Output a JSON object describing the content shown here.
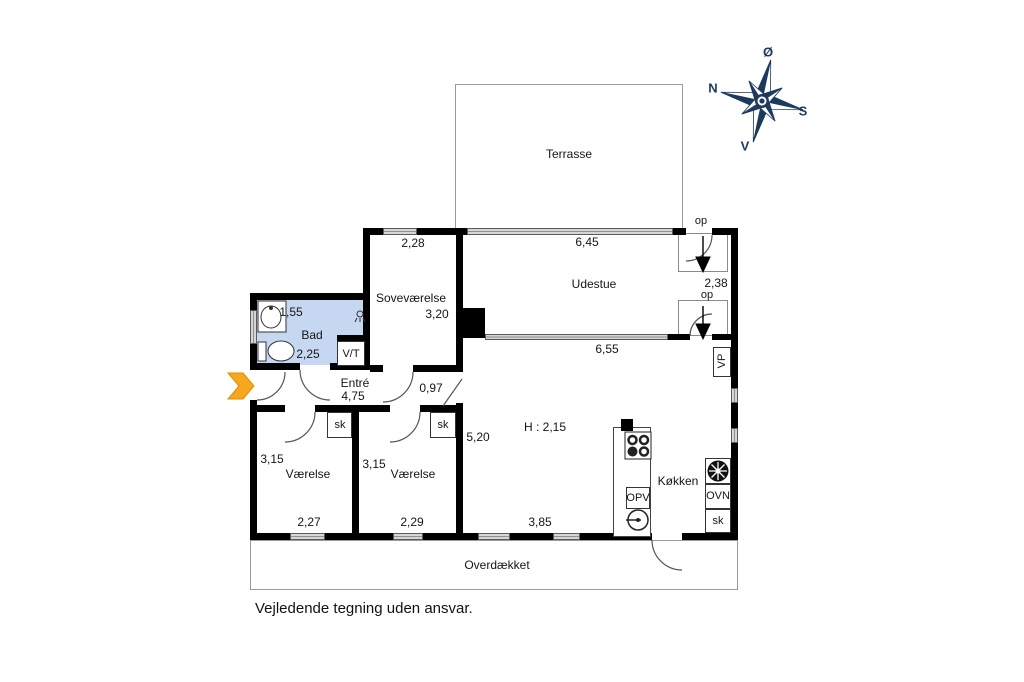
{
  "drawing": {
    "type": "floor-plan",
    "footer_disclaimer": "Vejledende tegning uden ansvar."
  },
  "colors": {
    "bathroom_blue": "#c6d7f2",
    "arrow_orange": "#F6A71B",
    "compass_navy": "#1d3a5c",
    "wall_black": "#000000",
    "window_gray": "#8f8f8f"
  },
  "compass": {
    "letters": [
      {
        "name": "compass-letter-east",
        "text": "Ø",
        "x": 768,
        "y": 52
      },
      {
        "name": "compass-letter-north",
        "text": "N",
        "x": 713,
        "y": 88
      },
      {
        "name": "compass-letter-south",
        "text": "S",
        "x": 803,
        "y": 111
      },
      {
        "name": "compass-letter-west",
        "text": "V",
        "x": 745,
        "y": 146
      }
    ]
  },
  "labels": [
    {
      "name": "room-label-terrasse",
      "text": "Terrasse",
      "x": 569,
      "y": 154
    },
    {
      "name": "dim-sovevaerelse-width",
      "text": "2,28",
      "x": 413,
      "y": 243
    },
    {
      "name": "dim-udestue-window",
      "text": "6,45",
      "x": 587,
      "y": 242
    },
    {
      "name": "room-label-sovevaerelse",
      "text": "Soveværelse",
      "x": 411,
      "y": 298
    },
    {
      "name": "dim-sovevaerelse-depth",
      "text": "3,20",
      "x": 437,
      "y": 314
    },
    {
      "name": "room-label-udestue",
      "text": "Udestue",
      "x": 594,
      "y": 284
    },
    {
      "name": "step-label-op-1",
      "text": "op",
      "x": 701,
      "y": 221,
      "cls": "small"
    },
    {
      "name": "dim-udestue-depth",
      "text": "2,38",
      "x": 716,
      "y": 283
    },
    {
      "name": "step-label-op-2",
      "text": "op",
      "x": 707,
      "y": 295,
      "cls": "small"
    },
    {
      "name": "dim-living-window",
      "text": "6,55",
      "x": 607,
      "y": 349
    },
    {
      "name": "dim-bad-width",
      "text": "1,55",
      "x": 291,
      "y": 312
    },
    {
      "name": "room-label-bad",
      "text": "Bad",
      "x": 312,
      "y": 335
    },
    {
      "name": "dim-bad-depth",
      "text": "2,25",
      "x": 308,
      "y": 354
    },
    {
      "name": "closet-label-vt",
      "text": "V/T",
      "x": 351,
      "y": 354,
      "cls": "small"
    },
    {
      "name": "room-label-entre",
      "text": "Entré",
      "x": 355,
      "y": 383
    },
    {
      "name": "dim-entre-width",
      "text": "4,75",
      "x": 353,
      "y": 396
    },
    {
      "name": "dim-door-width",
      "text": "0,97",
      "x": 431,
      "y": 388
    },
    {
      "name": "closet-label-sk-1",
      "text": "sk",
      "x": 340,
      "y": 425,
      "cls": "small"
    },
    {
      "name": "closet-label-sk-2",
      "text": "sk",
      "x": 443,
      "y": 425,
      "cls": "small"
    },
    {
      "name": "dim-vaerelse1-depth",
      "text": "3,15",
      "x": 272,
      "y": 459
    },
    {
      "name": "room-label-vaerelse-1",
      "text": "Værelse",
      "x": 308,
      "y": 474
    },
    {
      "name": "dim-vaerelse2-depth",
      "text": "3,15",
      "x": 374,
      "y": 464
    },
    {
      "name": "room-label-vaerelse-2",
      "text": "Værelse",
      "x": 413,
      "y": 474
    },
    {
      "name": "dim-vaerelse1-width",
      "text": "2,27",
      "x": 309,
      "y": 522
    },
    {
      "name": "dim-vaerelse2-width",
      "text": "2,29",
      "x": 412,
      "y": 522
    },
    {
      "name": "dim-living-depth",
      "text": "5,20",
      "x": 478,
      "y": 437
    },
    {
      "name": "label-ceiling-height",
      "text": "H : 2,15",
      "x": 545,
      "y": 427
    },
    {
      "name": "dim-living-width",
      "text": "3,85",
      "x": 540,
      "y": 522
    },
    {
      "name": "room-label-koekken",
      "text": "Køkken",
      "x": 678,
      "y": 481
    },
    {
      "name": "appliance-label-opv",
      "text": "OPV",
      "x": 638,
      "y": 498,
      "cls": "small"
    },
    {
      "name": "appliance-label-ovn",
      "text": "OVN",
      "x": 718,
      "y": 496,
      "cls": "small"
    },
    {
      "name": "closet-label-sk-3",
      "text": "sk",
      "x": 718,
      "y": 521,
      "cls": "small"
    },
    {
      "name": "label-vp",
      "text": "VP",
      "x": 722,
      "y": 361,
      "cls": "small rot"
    },
    {
      "name": "room-label-overdaekket",
      "text": "Overdækket",
      "x": 497,
      "y": 565
    }
  ]
}
